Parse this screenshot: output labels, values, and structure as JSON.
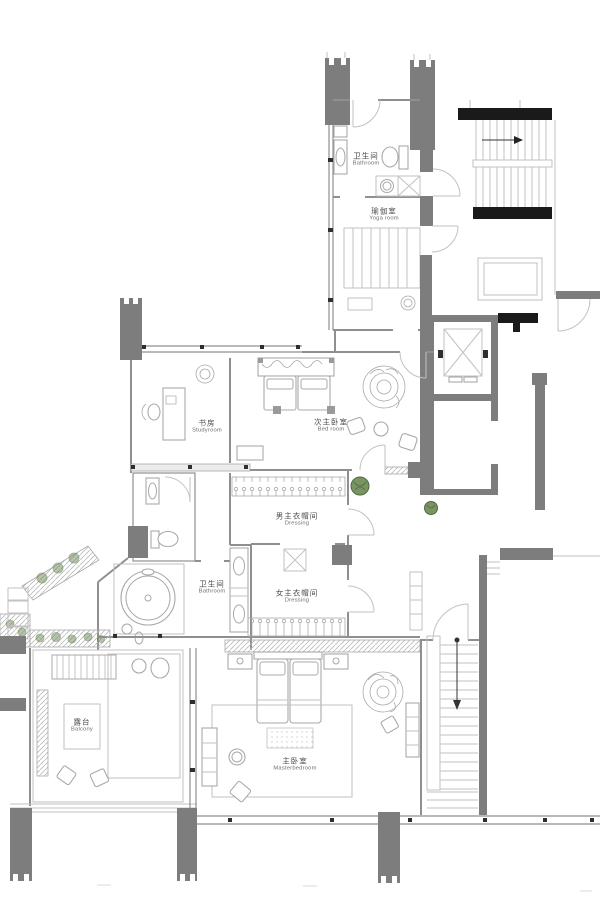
{
  "rooms": [
    {
      "id": "bathroom-top",
      "zh": "卫生间",
      "en": "Bathroom"
    },
    {
      "id": "yoga-room",
      "zh": "瑜伽室",
      "en": "Yoga room"
    },
    {
      "id": "studyroom",
      "zh": "书房",
      "en": "Studyroom"
    },
    {
      "id": "bedroom",
      "zh": "次主卧室",
      "en": "Bed room"
    },
    {
      "id": "dressing-men",
      "zh": "男主衣帽间",
      "en": "Dressing"
    },
    {
      "id": "bathroom-master",
      "zh": "卫生间",
      "en": "Bathroom"
    },
    {
      "id": "dressing-women",
      "zh": "女主衣帽间",
      "en": "Dressing"
    },
    {
      "id": "balcony",
      "zh": "露台",
      "en": "Balcony"
    },
    {
      "id": "master-bedroom",
      "zh": "主卧室",
      "en": "Masterbedroom"
    }
  ],
  "colors": {
    "wall_dark": "#7d7d7d",
    "wall_black": "#1a1a1a",
    "line": "#8f8f8f",
    "line_light": "#c2c2c2",
    "furn": "#a9a9a9",
    "hatch_bg": "#ececec",
    "plant": "#7a9464",
    "plant_dark": "#4d6b40",
    "text": "#4a4a4a",
    "mull": "#2e2e2e"
  }
}
